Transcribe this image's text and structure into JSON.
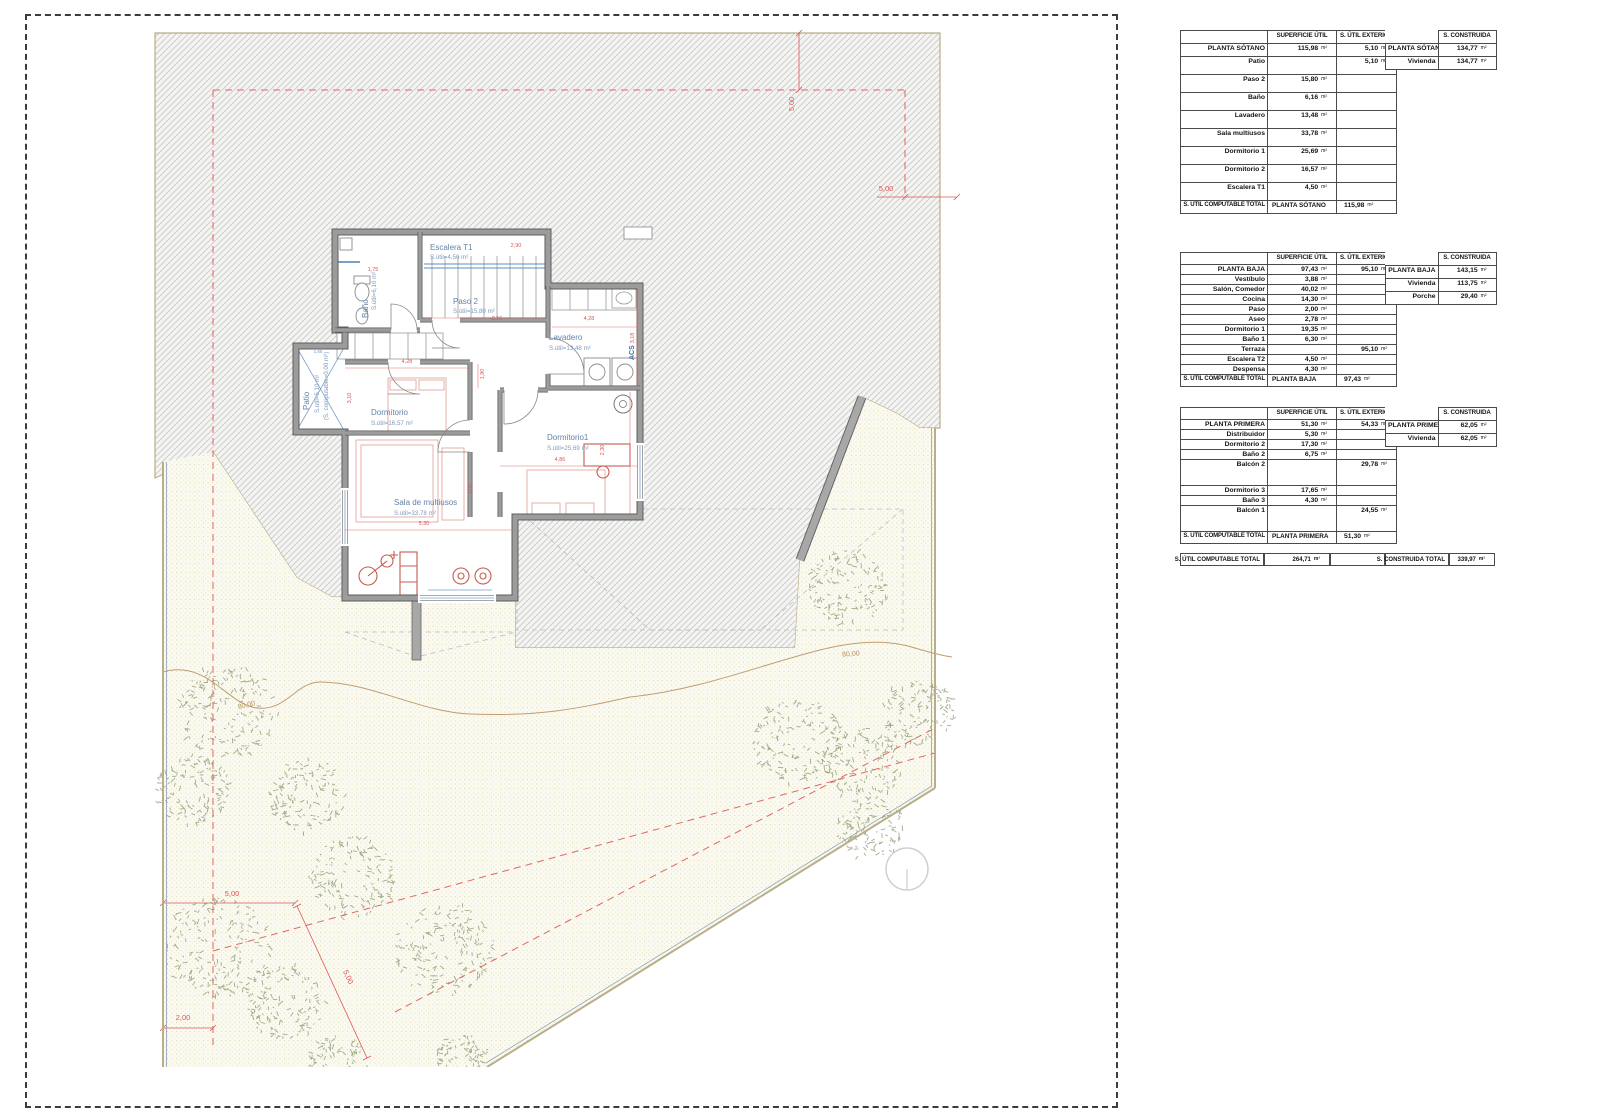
{
  "plan": {
    "rooms": {
      "escalera": {
        "name": "Escalera T1",
        "area": "S.útil=4,50 m²"
      },
      "paso2": {
        "name": "Paso 2",
        "area": "S.útil=15,80 m²"
      },
      "bano": {
        "name": "Baño",
        "area": "S.útil=6,16 m²"
      },
      "patio": {
        "name": "Patio",
        "area": "S.útil=5,10 m²",
        "note": "(S. computable=0,00 m²)"
      },
      "lavadero": {
        "name": "Lavadero",
        "area": "S.útil=13,48 m²"
      },
      "dormitorio": {
        "name": "Dormitorio",
        "area": "S.útil=16,57 m²"
      },
      "dormitorio1": {
        "name": "Dormitorio1",
        "area": "S.útil=25,69 m²"
      },
      "sala": {
        "name": "Sala de multiusos",
        "area": "S.útil=33,78 m²"
      },
      "acs": "ACS"
    },
    "dims": [
      {
        "t": "2,90",
        "x": 516,
        "y": 247,
        "r": 0,
        "c": "plan-red"
      },
      {
        "t": "1,75",
        "x": 373,
        "y": 271,
        "r": 0,
        "c": "plan-red"
      },
      {
        "t": "2,16",
        "x": 497,
        "y": 320,
        "r": 0,
        "c": "plan-red"
      },
      {
        "t": "4,28",
        "x": 589,
        "y": 320,
        "r": 0,
        "c": "plan-red"
      },
      {
        "t": "3,18",
        "x": 634,
        "y": 338,
        "r": -90,
        "c": "plan-red"
      },
      {
        "t": "4,28",
        "x": 407,
        "y": 363,
        "r": 0,
        "c": "plan-red"
      },
      {
        "t": "1,90",
        "x": 484,
        "y": 374,
        "r": -90,
        "c": "plan-red"
      },
      {
        "t": "3,10",
        "x": 351,
        "y": 398,
        "r": -90,
        "c": "plan-red"
      },
      {
        "t": "4,86",
        "x": 560,
        "y": 461,
        "r": 0,
        "c": "plan-red"
      },
      {
        "t": "2,30",
        "x": 604,
        "y": 450,
        "r": -90,
        "c": "plan-red"
      },
      {
        "t": "5,30",
        "x": 424,
        "y": 525,
        "r": 0,
        "c": "plan-red"
      },
      {
        "t": "3,05",
        "x": 472,
        "y": 489,
        "r": -90,
        "c": "plan-red"
      },
      {
        "t": "1,55",
        "x": 318,
        "y": 353,
        "r": 0,
        "c": "plan-blue"
      }
    ]
  },
  "site": {
    "dims": [
      {
        "t": "5,00",
        "x": 794,
        "y": 104,
        "r": -90,
        "c": "site-red"
      },
      {
        "t": "5,00",
        "x": 886,
        "y": 191,
        "r": 0,
        "c": "site-red"
      },
      {
        "t": "5,00",
        "x": 232,
        "y": 896,
        "r": 0,
        "c": "site-red"
      },
      {
        "t": "2,00",
        "x": 183,
        "y": 1020,
        "r": 0,
        "c": "site-red"
      },
      {
        "t": "5,00",
        "x": 346,
        "y": 978,
        "r": 66,
        "c": "site-red"
      },
      {
        "t": "80,00",
        "x": 247,
        "y": 707,
        "r": -14,
        "c": "site-tan"
      },
      {
        "t": "80,00",
        "x": 851,
        "y": 656,
        "r": -4,
        "c": "site-tan"
      }
    ],
    "trees": [
      [
        228,
        712,
        50
      ],
      [
        192,
        790,
        38
      ],
      [
        218,
        948,
        56
      ],
      [
        285,
        1002,
        40
      ],
      [
        352,
        878,
        44
      ],
      [
        445,
        950,
        50
      ],
      [
        308,
        795,
        40
      ],
      [
        848,
        588,
        40
      ],
      [
        798,
        742,
        46
      ],
      [
        862,
        764,
        40
      ],
      [
        918,
        712,
        36
      ],
      [
        872,
        828,
        34
      ],
      [
        338,
        1062,
        30
      ],
      [
        462,
        1058,
        26
      ]
    ]
  },
  "tables": {
    "unit": "m²",
    "headers": {
      "col2": "SUPERFICIE ÚTIL",
      "col3": "S. ÚTIL EXTERIOR",
      "constructed": "S. CONSTRUIDA"
    },
    "sotano": {
      "rows": [
        {
          "label": "PLANTA SÓTANO",
          "util": "115,98",
          "ext": "5,10"
        },
        {
          "label": "Patio",
          "util": "",
          "ext": "5,10"
        },
        {
          "label": "Paso 2",
          "util": "15,80",
          "ext": ""
        },
        {
          "label": "Baño",
          "util": "6,16",
          "ext": ""
        },
        {
          "label": "Lavadero",
          "util": "13,48",
          "ext": ""
        },
        {
          "label": "Sala multiusos",
          "util": "33,78",
          "ext": ""
        },
        {
          "label": "Dormitorio 1",
          "util": "25,69",
          "ext": ""
        },
        {
          "label": "Dormitorio 2",
          "util": "16,57",
          "ext": ""
        },
        {
          "label": "Escalera T1",
          "util": "4,50",
          "ext": ""
        }
      ],
      "footer": {
        "c1": "S. ÚTIL COMPUTABLE TOTAL",
        "c2": "PLANTA SÓTANO",
        "value": "115,98"
      },
      "constructed": [
        {
          "label": "PLANTA SÓTANO",
          "value": "134,77"
        },
        {
          "label": "Vivienda",
          "value": "134,77"
        }
      ]
    },
    "baja": {
      "rows": [
        {
          "label": "PLANTA BAJA",
          "util": "97,43",
          "ext": "95,10"
        },
        {
          "label": "Vestíbulo",
          "util": "3,88",
          "ext": ""
        },
        {
          "label": "Salón, Comedor",
          "util": "40,02",
          "ext": ""
        },
        {
          "label": "Cocina",
          "util": "14,30",
          "ext": ""
        },
        {
          "label": "Paso",
          "util": "2,00",
          "ext": ""
        },
        {
          "label": "Aseo",
          "util": "2,78",
          "ext": ""
        },
        {
          "label": "Dormitorio 1",
          "util": "19,35",
          "ext": ""
        },
        {
          "label": "Baño 1",
          "util": "6,30",
          "ext": ""
        },
        {
          "label": "Terraza",
          "util": "",
          "ext": "95,10"
        },
        {
          "label": "Escalera T2",
          "util": "4,50",
          "ext": ""
        },
        {
          "label": "Despensa",
          "util": "4,30",
          "ext": ""
        }
      ],
      "footer": {
        "c1": "S. ÚTIL COMPUTABLE TOTAL",
        "c2": "PLANTA BAJA",
        "value": "97,43"
      },
      "constructed": [
        {
          "label": "PLANTA BAJA",
          "value": "143,15"
        },
        {
          "label": "Vivienda",
          "value": "113,75"
        },
        {
          "label": "Porche",
          "value": "29,40"
        }
      ]
    },
    "primera": {
      "rows": [
        {
          "label": "PLANTA PRIMERA",
          "util": "51,30",
          "ext": "54,33"
        },
        {
          "label": "Distribuidor",
          "util": "5,30",
          "ext": ""
        },
        {
          "label": "Dormitorio 2",
          "util": "17,30",
          "ext": ""
        },
        {
          "label": "Baño 2",
          "util": "6,75",
          "ext": ""
        },
        {
          "label": "Balcón 2",
          "util": "",
          "ext": "29,78",
          "tall": true
        },
        {
          "label": "Dormitorio 3",
          "util": "17,65",
          "ext": ""
        },
        {
          "label": "Baño 3",
          "util": "4,30",
          "ext": ""
        },
        {
          "label": "Balcón 1",
          "util": "",
          "ext": "24,55",
          "tall": true
        }
      ],
      "footer": {
        "c1": "S. ÚTIL COMPUTABLE TOTAL",
        "c2": "PLANTA PRIMERA",
        "value": "51,30"
      },
      "constructed": [
        {
          "label": "PLANTA PRIMERA",
          "value": "62,05"
        },
        {
          "label": "Vivienda",
          "value": "62,05"
        }
      ]
    },
    "totals": {
      "util_label": "S. ÚTIL COMPUTABLE TOTAL",
      "util_value": "264,71",
      "constr_label": "S. CONSTRUIDA TOTAL",
      "constr_value": "339,97"
    }
  }
}
